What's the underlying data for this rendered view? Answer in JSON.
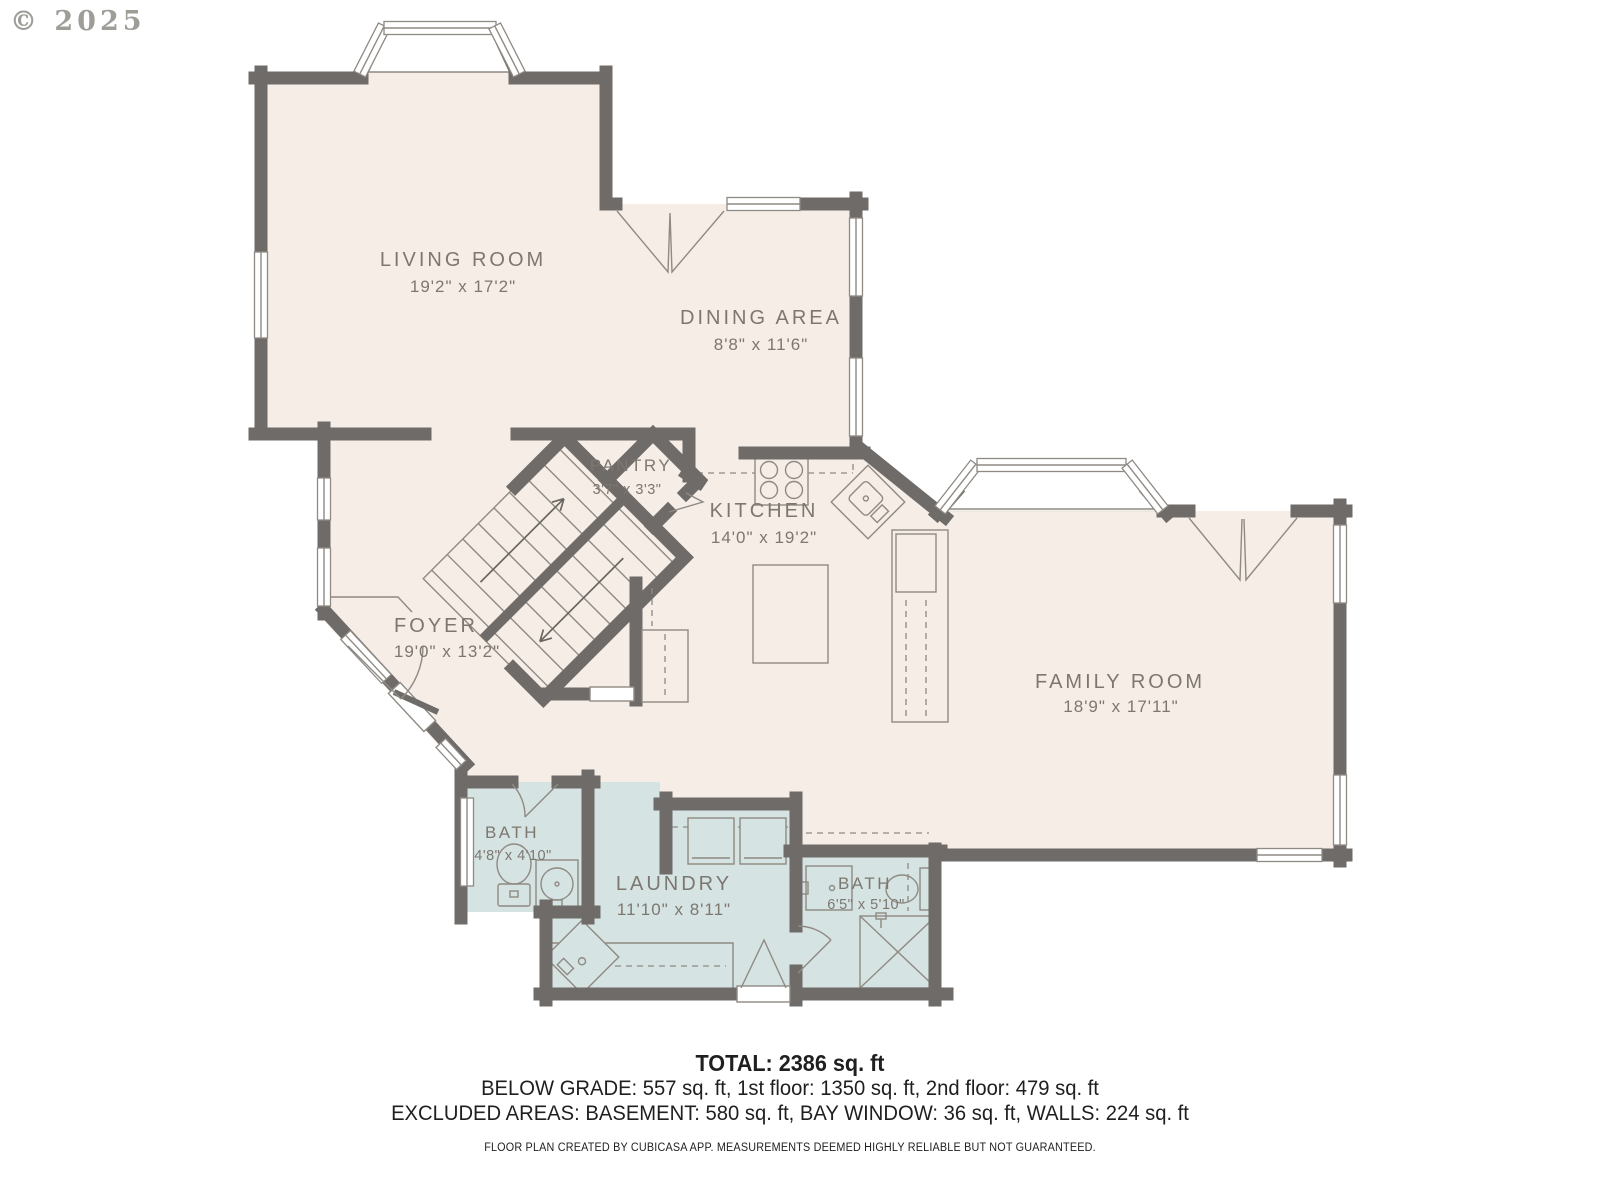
{
  "copyright": "© 2025",
  "colors": {
    "floor": "#f6ede7",
    "wet_room": "#d5e3e2",
    "wall": "#6e6b68",
    "thin_line": "#8f8a83",
    "label_text": "#7d7770",
    "footer_text": "#1f1f1f"
  },
  "rooms": {
    "living": {
      "name": "LIVING ROOM",
      "dims": "19'2\" x 17'2\""
    },
    "dining": {
      "name": "DINING AREA",
      "dims": "8'8\" x 11'6\""
    },
    "pantry": {
      "name": "PANTRY",
      "dims": "3'7\" x 3'3\""
    },
    "kitchen": {
      "name": "KITCHEN",
      "dims": "14'0\" x 19'2\""
    },
    "foyer": {
      "name": "FOYER",
      "dims": "19'0\" x 13'2\""
    },
    "family": {
      "name": "FAMILY ROOM",
      "dims": "18'9\" x 17'11\""
    },
    "bath1": {
      "name": "BATH",
      "dims": "4'8\" x 4'10\""
    },
    "laundry": {
      "name": "LAUNDRY",
      "dims": "11'10\" x 8'11\""
    },
    "bath2": {
      "name": "BATH",
      "dims": "6'5\" x 5'10\""
    }
  },
  "footer": {
    "total": "TOTAL: 2386 sq. ft",
    "line2": "BELOW GRADE: 557 sq. ft, 1st floor: 1350 sq. ft, 2nd floor: 479 sq. ft",
    "line3": "EXCLUDED AREAS: BASEMENT: 580 sq. ft, BAY WINDOW: 36 sq. ft, WALLS: 224 sq. ft",
    "disclaimer": "FLOOR PLAN CREATED BY CUBICASA APP. MEASUREMENTS DEEMED HIGHLY RELIABLE BUT NOT GUARANTEED."
  }
}
